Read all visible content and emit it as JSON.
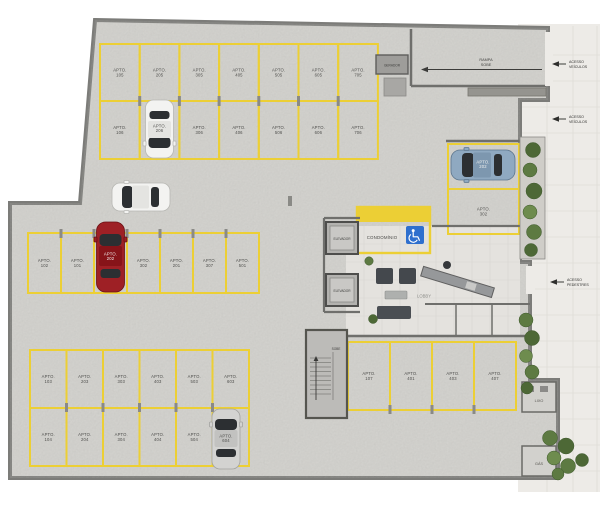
{
  "colors": {
    "line_yellow": "#eccf35",
    "wall": "#6f6f6c",
    "concrete": "#d8d7d3",
    "sidewalk": "#edebe7",
    "accessible_blue": "#2e6fce",
    "car_red": "#9e2025",
    "car_blue": "#8fa9c1",
    "car_white": "#f3f3f1",
    "car_silver": "#d3d3d1",
    "plant_green": "#5d7a42"
  },
  "icons": {
    "accessible_parking": "wheelchair-icon",
    "access_direction": "left-arrow-icon"
  },
  "labels": {
    "apto_prefix": "APTO.",
    "gerador": "GERADOR",
    "rampa": "RAMPA",
    "sobe": "SOBE",
    "acesso": "ACESSO",
    "veiculos": "VEÍCULOS",
    "pedestres": "PEDESTRES",
    "elevador": "ELEVADOR",
    "condominio": "CONDOMÍNIO",
    "lobby": "LOBBY",
    "lixo": "LIXO",
    "gas": "GÁS"
  },
  "spots": {
    "row_a1": [
      "105",
      "205",
      "305",
      "405",
      "505",
      "605",
      "705"
    ],
    "row_a2": [
      "106",
      "206",
      "306",
      "406",
      "506",
      "606",
      "706"
    ],
    "row_b": [
      "102",
      "101",
      "202",
      "302",
      "201",
      "307",
      "501"
    ],
    "row_c1": [
      "103",
      "203",
      "303",
      "403",
      "503",
      "603"
    ],
    "row_c2": [
      "104",
      "204",
      "304",
      "404",
      "504",
      "604"
    ],
    "row_d": [
      "107",
      "401",
      "403",
      "407"
    ],
    "row_e": [
      "202",
      "302"
    ]
  }
}
